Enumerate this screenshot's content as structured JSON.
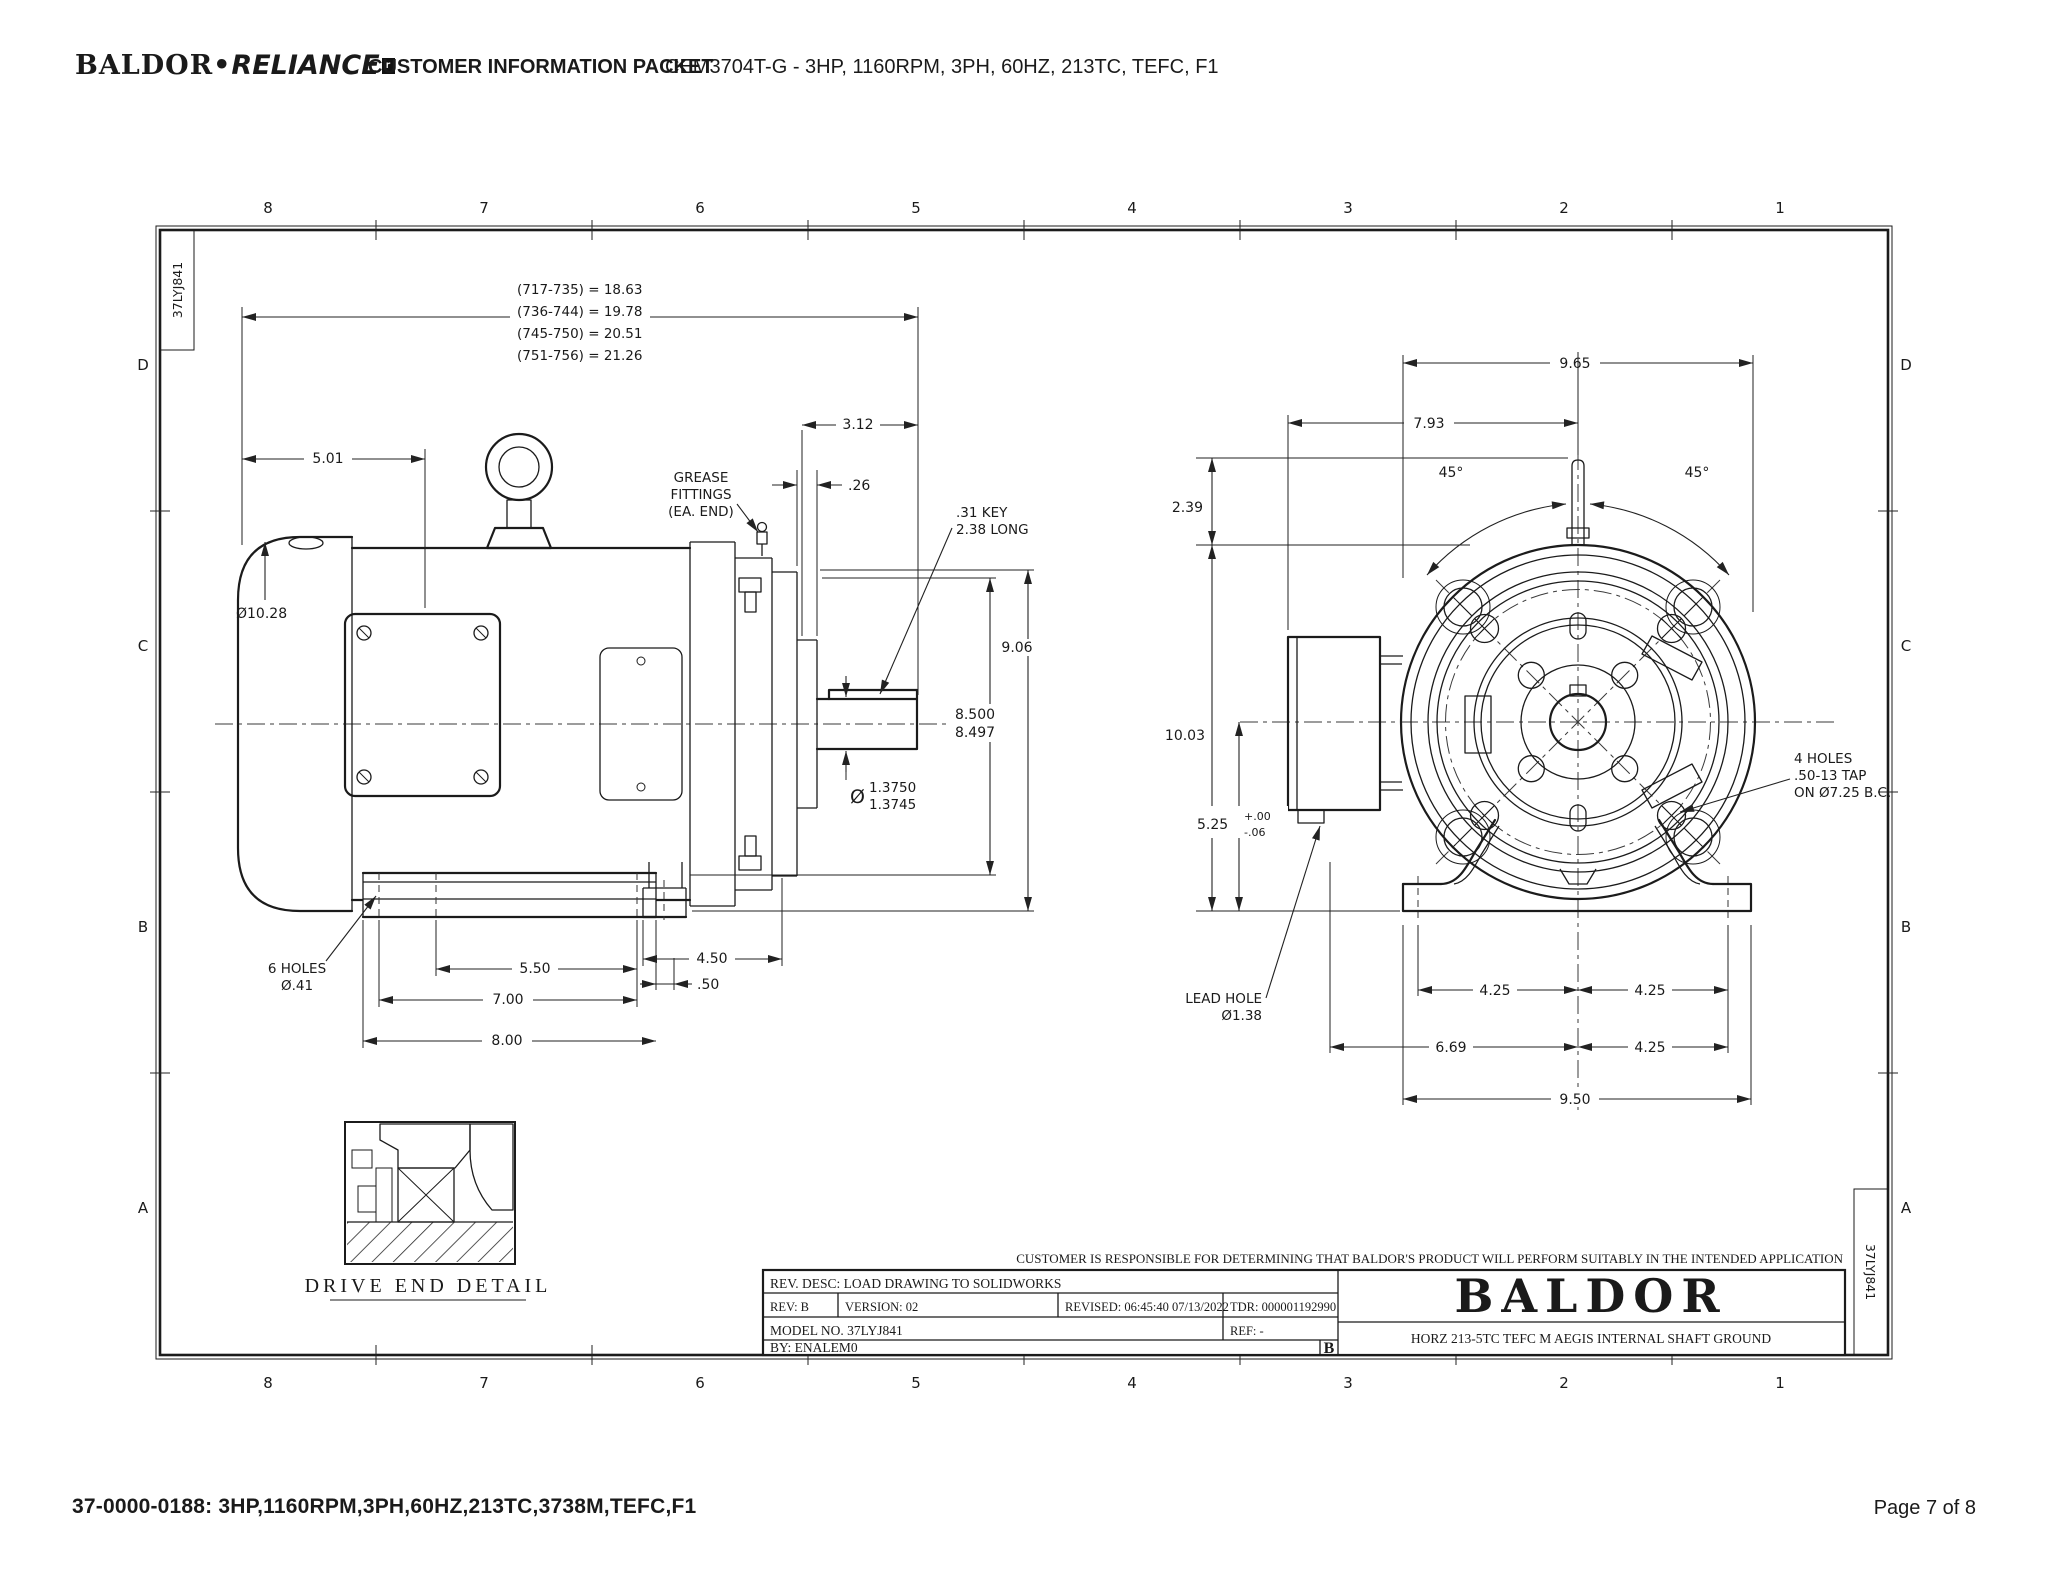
{
  "header": {
    "brand_baldor": "BALDOR",
    "brand_dot": "•",
    "brand_reliance": "RELIANCE",
    "brand_mark": "r",
    "doc_title": "CUSTOMER INFORMATION PACKET",
    "spec": "CEM3704T-G - 3HP, 1160RPM, 3PH, 60HZ, 213TC, TEFC, F1"
  },
  "footer": {
    "part_line": "37-0000-0188: 3HP,1160RPM,3PH,60HZ,213TC,3738M,TEFC,F1",
    "page": "Page 7 of 8"
  },
  "sheet": {
    "grid_cols": [
      "8",
      "7",
      "6",
      "5",
      "4",
      "3",
      "2",
      "1"
    ],
    "grid_rows": [
      "D",
      "C",
      "B",
      "A"
    ],
    "stamp_top_left": "37LYJ841",
    "stamp_bottom_right": "37LYJ841"
  },
  "side_view": {
    "length_table": [
      "(717-735) = 18.63",
      "(736-744) = 19.78",
      "(745-750) = 20.51",
      "(751-756) = 21.26"
    ],
    "dim_5_01": "5.01",
    "dim_frame_dia": "Ø10.28",
    "grease_label": [
      "GREASE",
      "FITTINGS",
      "(EA. END)"
    ],
    "dim_3_12": "3.12",
    "dim_0_26": ".26",
    "key_label": [
      ".31 KEY",
      "2.38 LONG"
    ],
    "dim_9_06": "9.06",
    "dim_8_500": "8.500",
    "dim_8_497": "8.497",
    "shaft_dia_symbol": "Ø",
    "shaft_dia_upper": "1.3750",
    "shaft_dia_lower": "1.3745",
    "holes_label": [
      "6 HOLES",
      "Ø.41"
    ],
    "dim_5_50": "5.50",
    "dim_4_50": "4.50",
    "dim_7_00": "7.00",
    "dim_0_50": ".50",
    "dim_8_00": "8.00"
  },
  "end_view": {
    "dim_9_65": "9.65",
    "dim_7_93": "7.93",
    "angle_left": "45°",
    "angle_right": "45°",
    "dim_2_39": "2.39",
    "dim_10_03": "10.03",
    "dim_5_25": "5.25",
    "tol_plus": "+.00",
    "tol_minus": "-.06",
    "lead_hole_label": [
      "LEAD HOLE",
      "Ø1.38"
    ],
    "tap_label": [
      "4 HOLES",
      ".50-13 TAP",
      "ON Ø7.25 B.C."
    ],
    "dim_4_25_a": "4.25",
    "dim_4_25_b": "4.25",
    "dim_6_69": "6.69",
    "dim_4_25_c": "4.25",
    "dim_9_50": "9.50"
  },
  "detail": {
    "label": "DRIVE END DETAIL"
  },
  "title_block": {
    "disclaimer": "CUSTOMER IS RESPONSIBLE FOR DETERMINING THAT BALDOR'S PRODUCT WILL PERFORM SUITABLY IN THE INTENDED APPLICATION",
    "rev_desc": "REV. DESC: LOAD DRAWING TO SOLIDWORKS",
    "rev": "REV:  B",
    "version": "VERSION:  02",
    "revised": "REVISED:  06:45:40 07/13/2022",
    "tdr": "TDR:  000001192990",
    "model_no": "MODEL NO.  37LYJ841",
    "ref": "REF:  -",
    "by": "BY: ENALEM0",
    "rev_letter": "B",
    "logo": "BALDOR",
    "description": "HORZ 213-5TC TEFC M AEGIS INTERNAL SHAFT GROUND"
  }
}
